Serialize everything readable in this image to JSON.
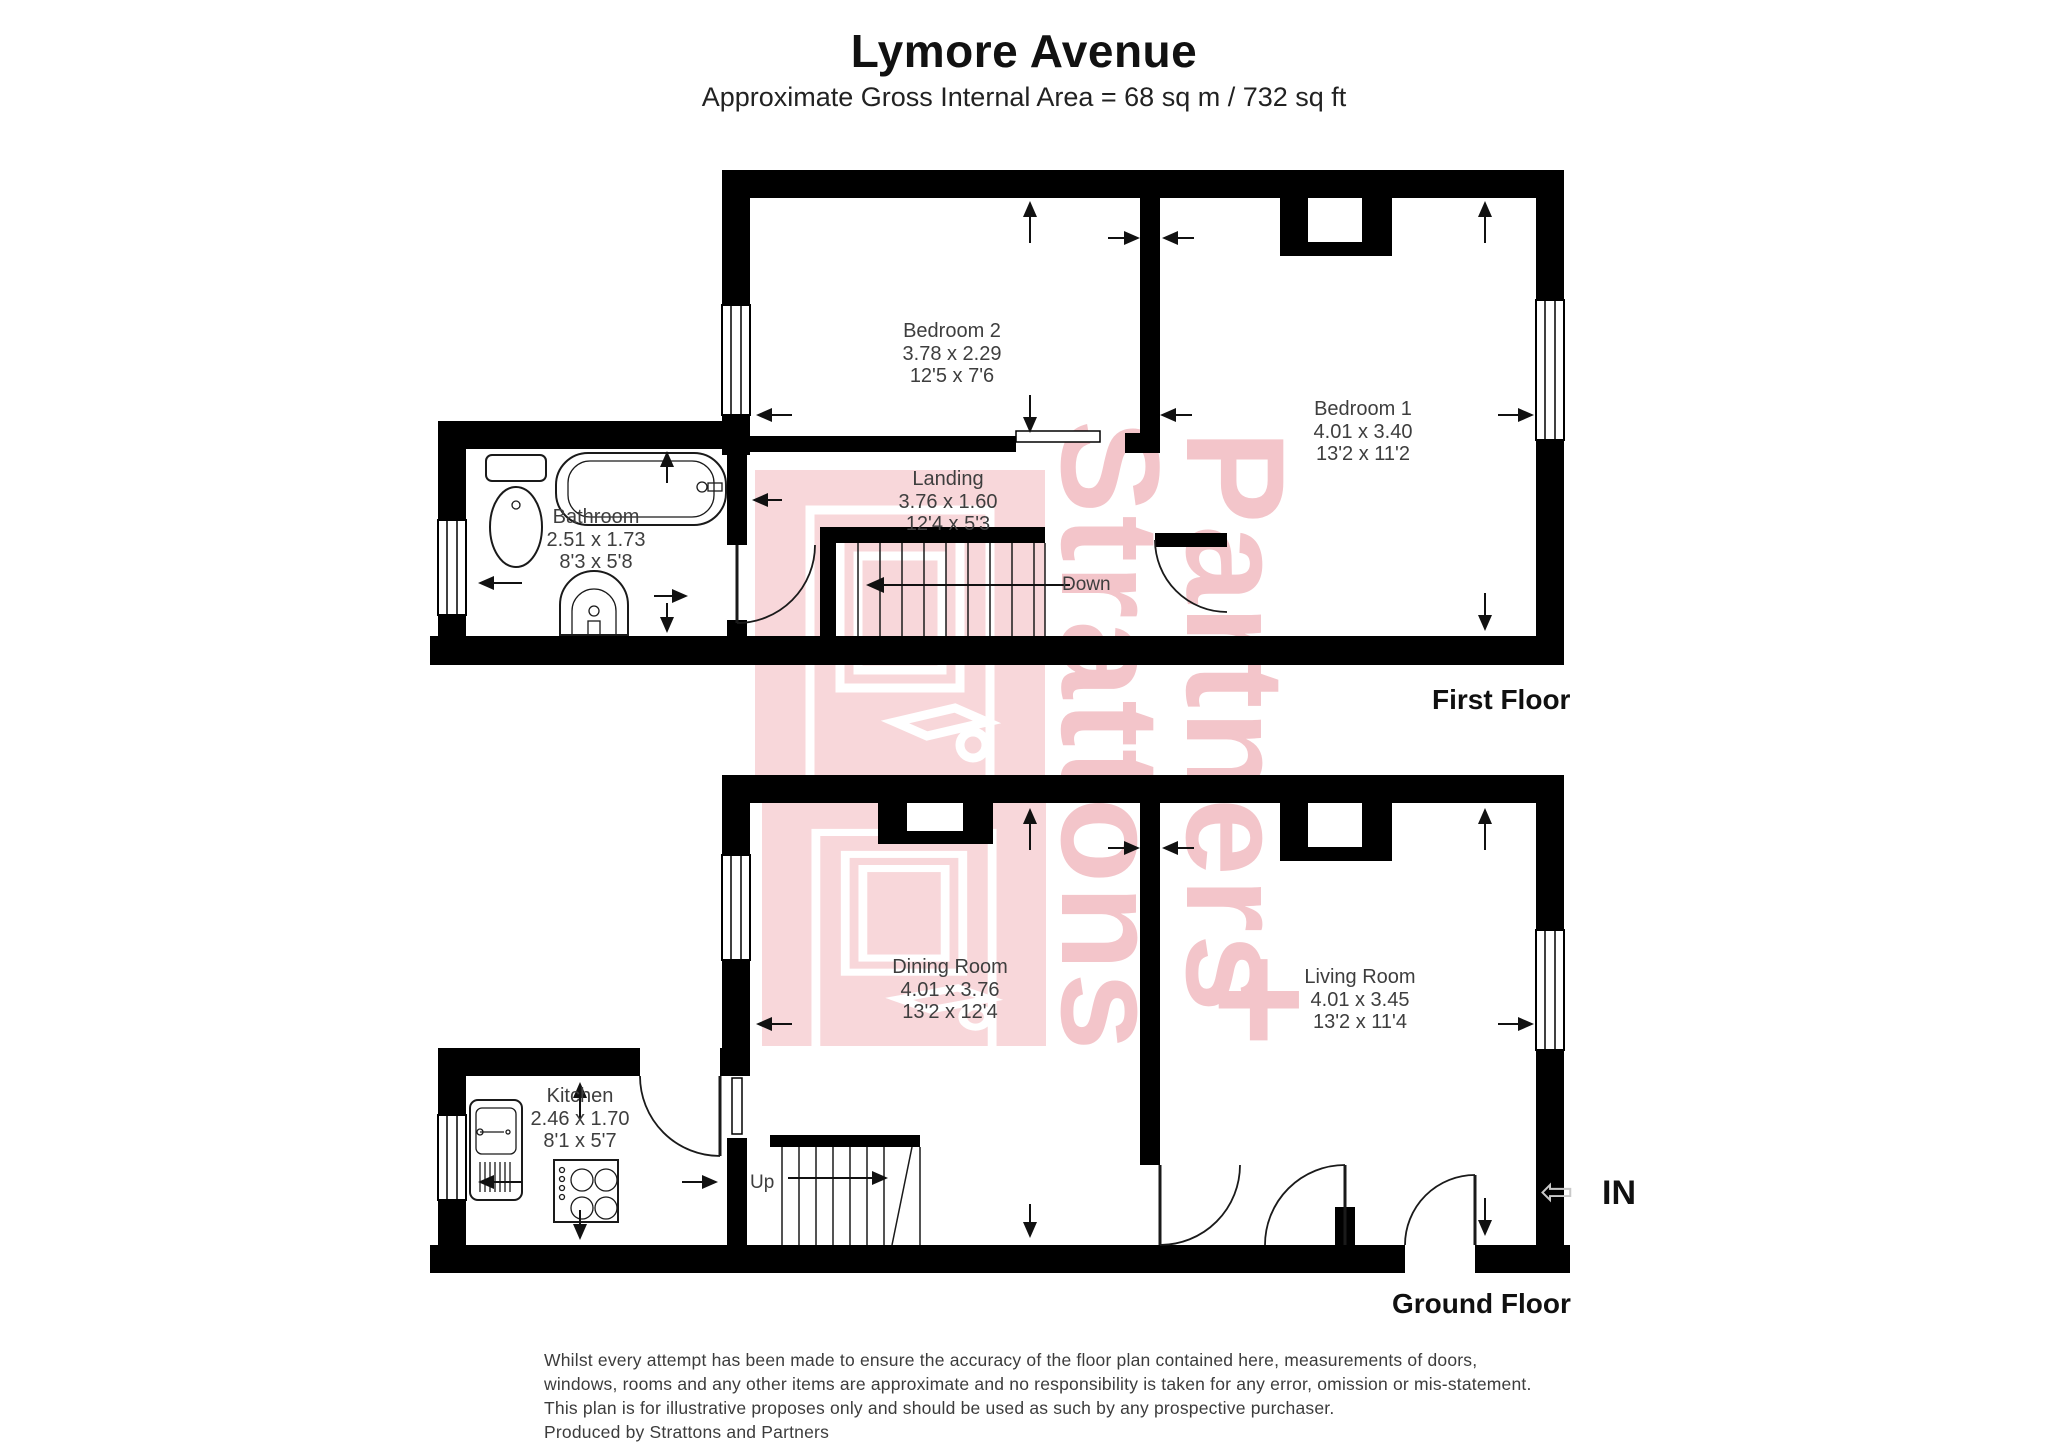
{
  "header": {
    "title": "Lymore Avenue",
    "subtitle": "Approximate Gross Internal Area = 68 sq m / 732 sq ft"
  },
  "rooms": {
    "bedroom2": {
      "name": "Bedroom 2",
      "metric": "3.78 x 2.29",
      "imperial": "12'5 x 7'6"
    },
    "bedroom1": {
      "name": "Bedroom 1",
      "metric": "4.01 x 3.40",
      "imperial": "13'2 x 11'2"
    },
    "landing": {
      "name": "Landing",
      "metric": "3.76 x 1.60",
      "imperial": "12'4 x 5'3"
    },
    "bathroom": {
      "name": "Bathroom",
      "metric": "2.51 x 1.73",
      "imperial": "8'3 x 5'8"
    },
    "dining": {
      "name": "Dining Room",
      "metric": "4.01 x 3.76",
      "imperial": "13'2 x 12'4"
    },
    "living": {
      "name": "Living Room",
      "metric": "4.01 x 3.45",
      "imperial": "13'2 x 11'4"
    },
    "kitchen": {
      "name": "Kitchen",
      "metric": "2.46 x 1.70",
      "imperial": "8'1 x 5'7"
    }
  },
  "stairs": {
    "down_label": "Down",
    "up_label": "Up"
  },
  "entrance": {
    "label": "IN",
    "arrow_icon": "⇦"
  },
  "floor_labels": {
    "first": "First Floor",
    "ground": "Ground Floor"
  },
  "watermark": {
    "word1": "Strattons",
    "word2": "Partners",
    "plus": "+",
    "text_color": "#f3c5ca",
    "block_color": "#f8d7da"
  },
  "disclaimer": {
    "lines": [
      "Whilst every attempt has been made to ensure the accuracy of the floor plan contained here, measurements of doors,",
      "windows, rooms and any other items are approximate and no responsibility is taken for any error, omission or mis-statement.",
      "This plan is for illustrative proposes only and should be used as such by any prospective purchaser.",
      "Produced by Strattons and Partners"
    ]
  },
  "colors": {
    "wall": "#000000",
    "label_text": "#3e3e3e"
  }
}
